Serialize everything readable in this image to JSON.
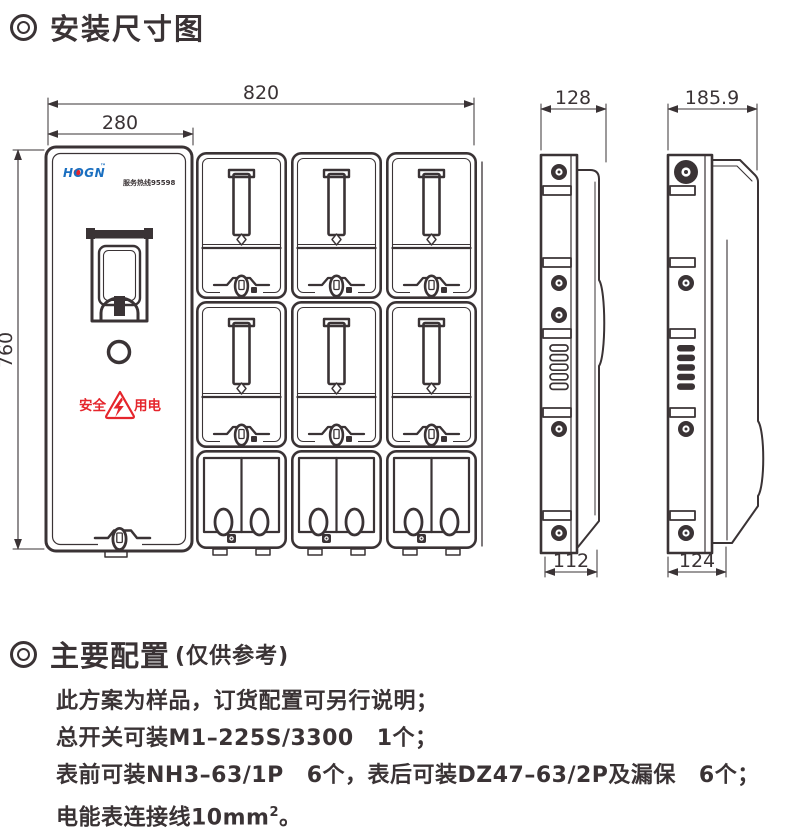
{
  "title": {
    "text": "安装尺寸图"
  },
  "front_view": {
    "dim_width": "820",
    "dim_panel": "280",
    "dim_height": "760",
    "logo_text": "HOGN",
    "logo_tm": "™",
    "hotline": "服务热线95598",
    "warn_left": "安全",
    "warn_right": "用电"
  },
  "side_view_small": {
    "dim_top": "128",
    "dim_bottom": "112"
  },
  "side_view_large": {
    "dim_top": "185.9",
    "dim_bottom": "124"
  },
  "config": {
    "heading": "主要配置",
    "heading_note": "(仅供参考)",
    "line1": "此方案为样品，订货配置可另行说明；",
    "line2": "总开关可装M1–225S/3300  1个；",
    "line3": "表前可装NH3–63/1P  6个，表后可装DZ47–63/2P及漏保  6个；",
    "line4_pre": "电能表连接线10mm",
    "line4_sup": "2",
    "line4_end": "。"
  },
  "colors": {
    "ink": "#3a3335",
    "red": "#e5252c",
    "blue": "#1a6fc0"
  }
}
